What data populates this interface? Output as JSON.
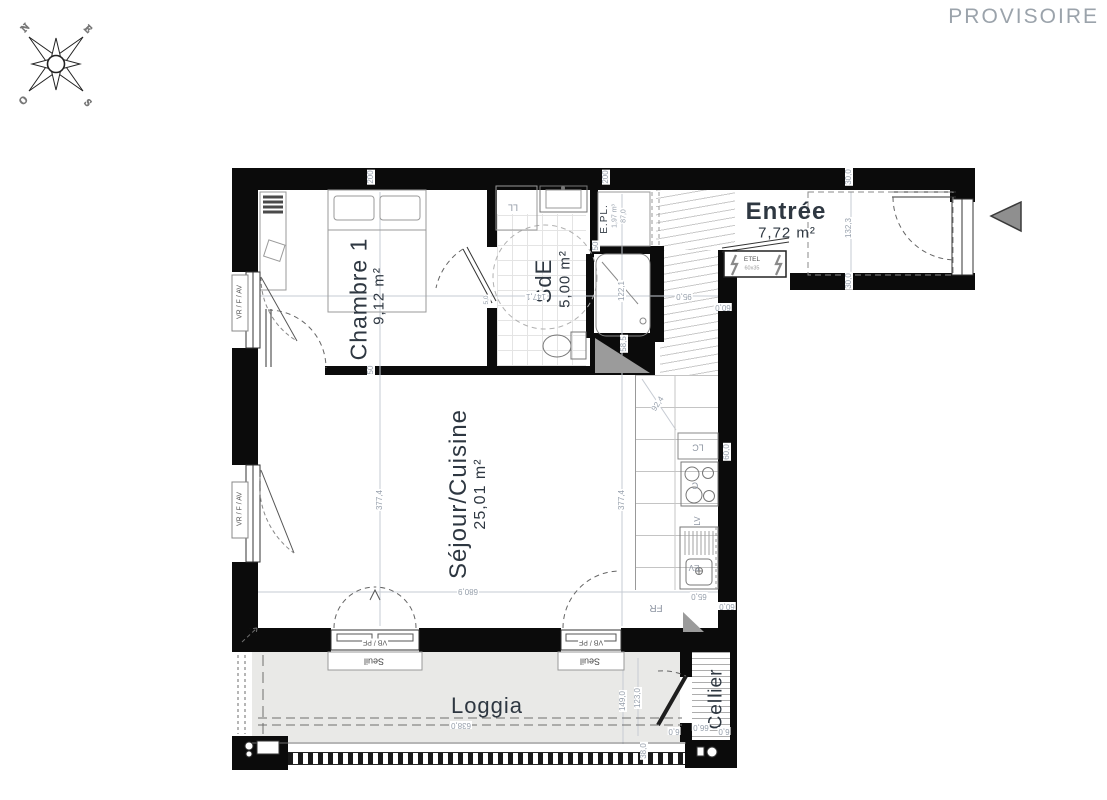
{
  "header": {
    "status": "PROVISOIRE"
  },
  "compass": {
    "north": "N",
    "east": "E",
    "west": "O",
    "south": "S"
  },
  "rooms": {
    "chambre": {
      "name": "Chambre 1",
      "area": "9,12 m²"
    },
    "sde": {
      "name": "SdE",
      "area": "5,00 m²"
    },
    "sejour": {
      "name": "Séjour/Cuisine",
      "area": "25,01 m²"
    },
    "entree": {
      "name": "Entrée",
      "area": "7,72 m²"
    },
    "loggia": {
      "name": "Loggia"
    },
    "cellier": {
      "name": "Cellier"
    },
    "placard": {
      "name": "E.PL.",
      "volume": "1,97 m³"
    }
  },
  "fixtures": {
    "washing_machine": "LL",
    "tall_unit": "LC",
    "cooktop": "C",
    "dishwasher": "LV",
    "sink": "EV",
    "fridge": "FR",
    "electrical_panel": "ETEL",
    "electrical_panel_size": "60x35"
  },
  "openings": {
    "window_roller": "VR / F / AV",
    "window_bottom": "VB / PF",
    "sill": "Seuil"
  },
  "dims": [
    "200",
    "50",
    "377,4",
    "200",
    "50",
    "58,5",
    "122,1",
    "147,1",
    "95,0",
    "60,0",
    "5,0",
    "87,0",
    "30,0",
    "132,3",
    "30,0",
    "377,4",
    "92,4",
    "680,9",
    "65,0",
    "60,0",
    "638,0",
    "149,0",
    "123,0",
    "38,0",
    "66,0",
    "6,0",
    "6,0",
    "60,0"
  ],
  "icons": {
    "entrance_arrow": "left-triangle",
    "electrical_bolt": "lightning"
  }
}
